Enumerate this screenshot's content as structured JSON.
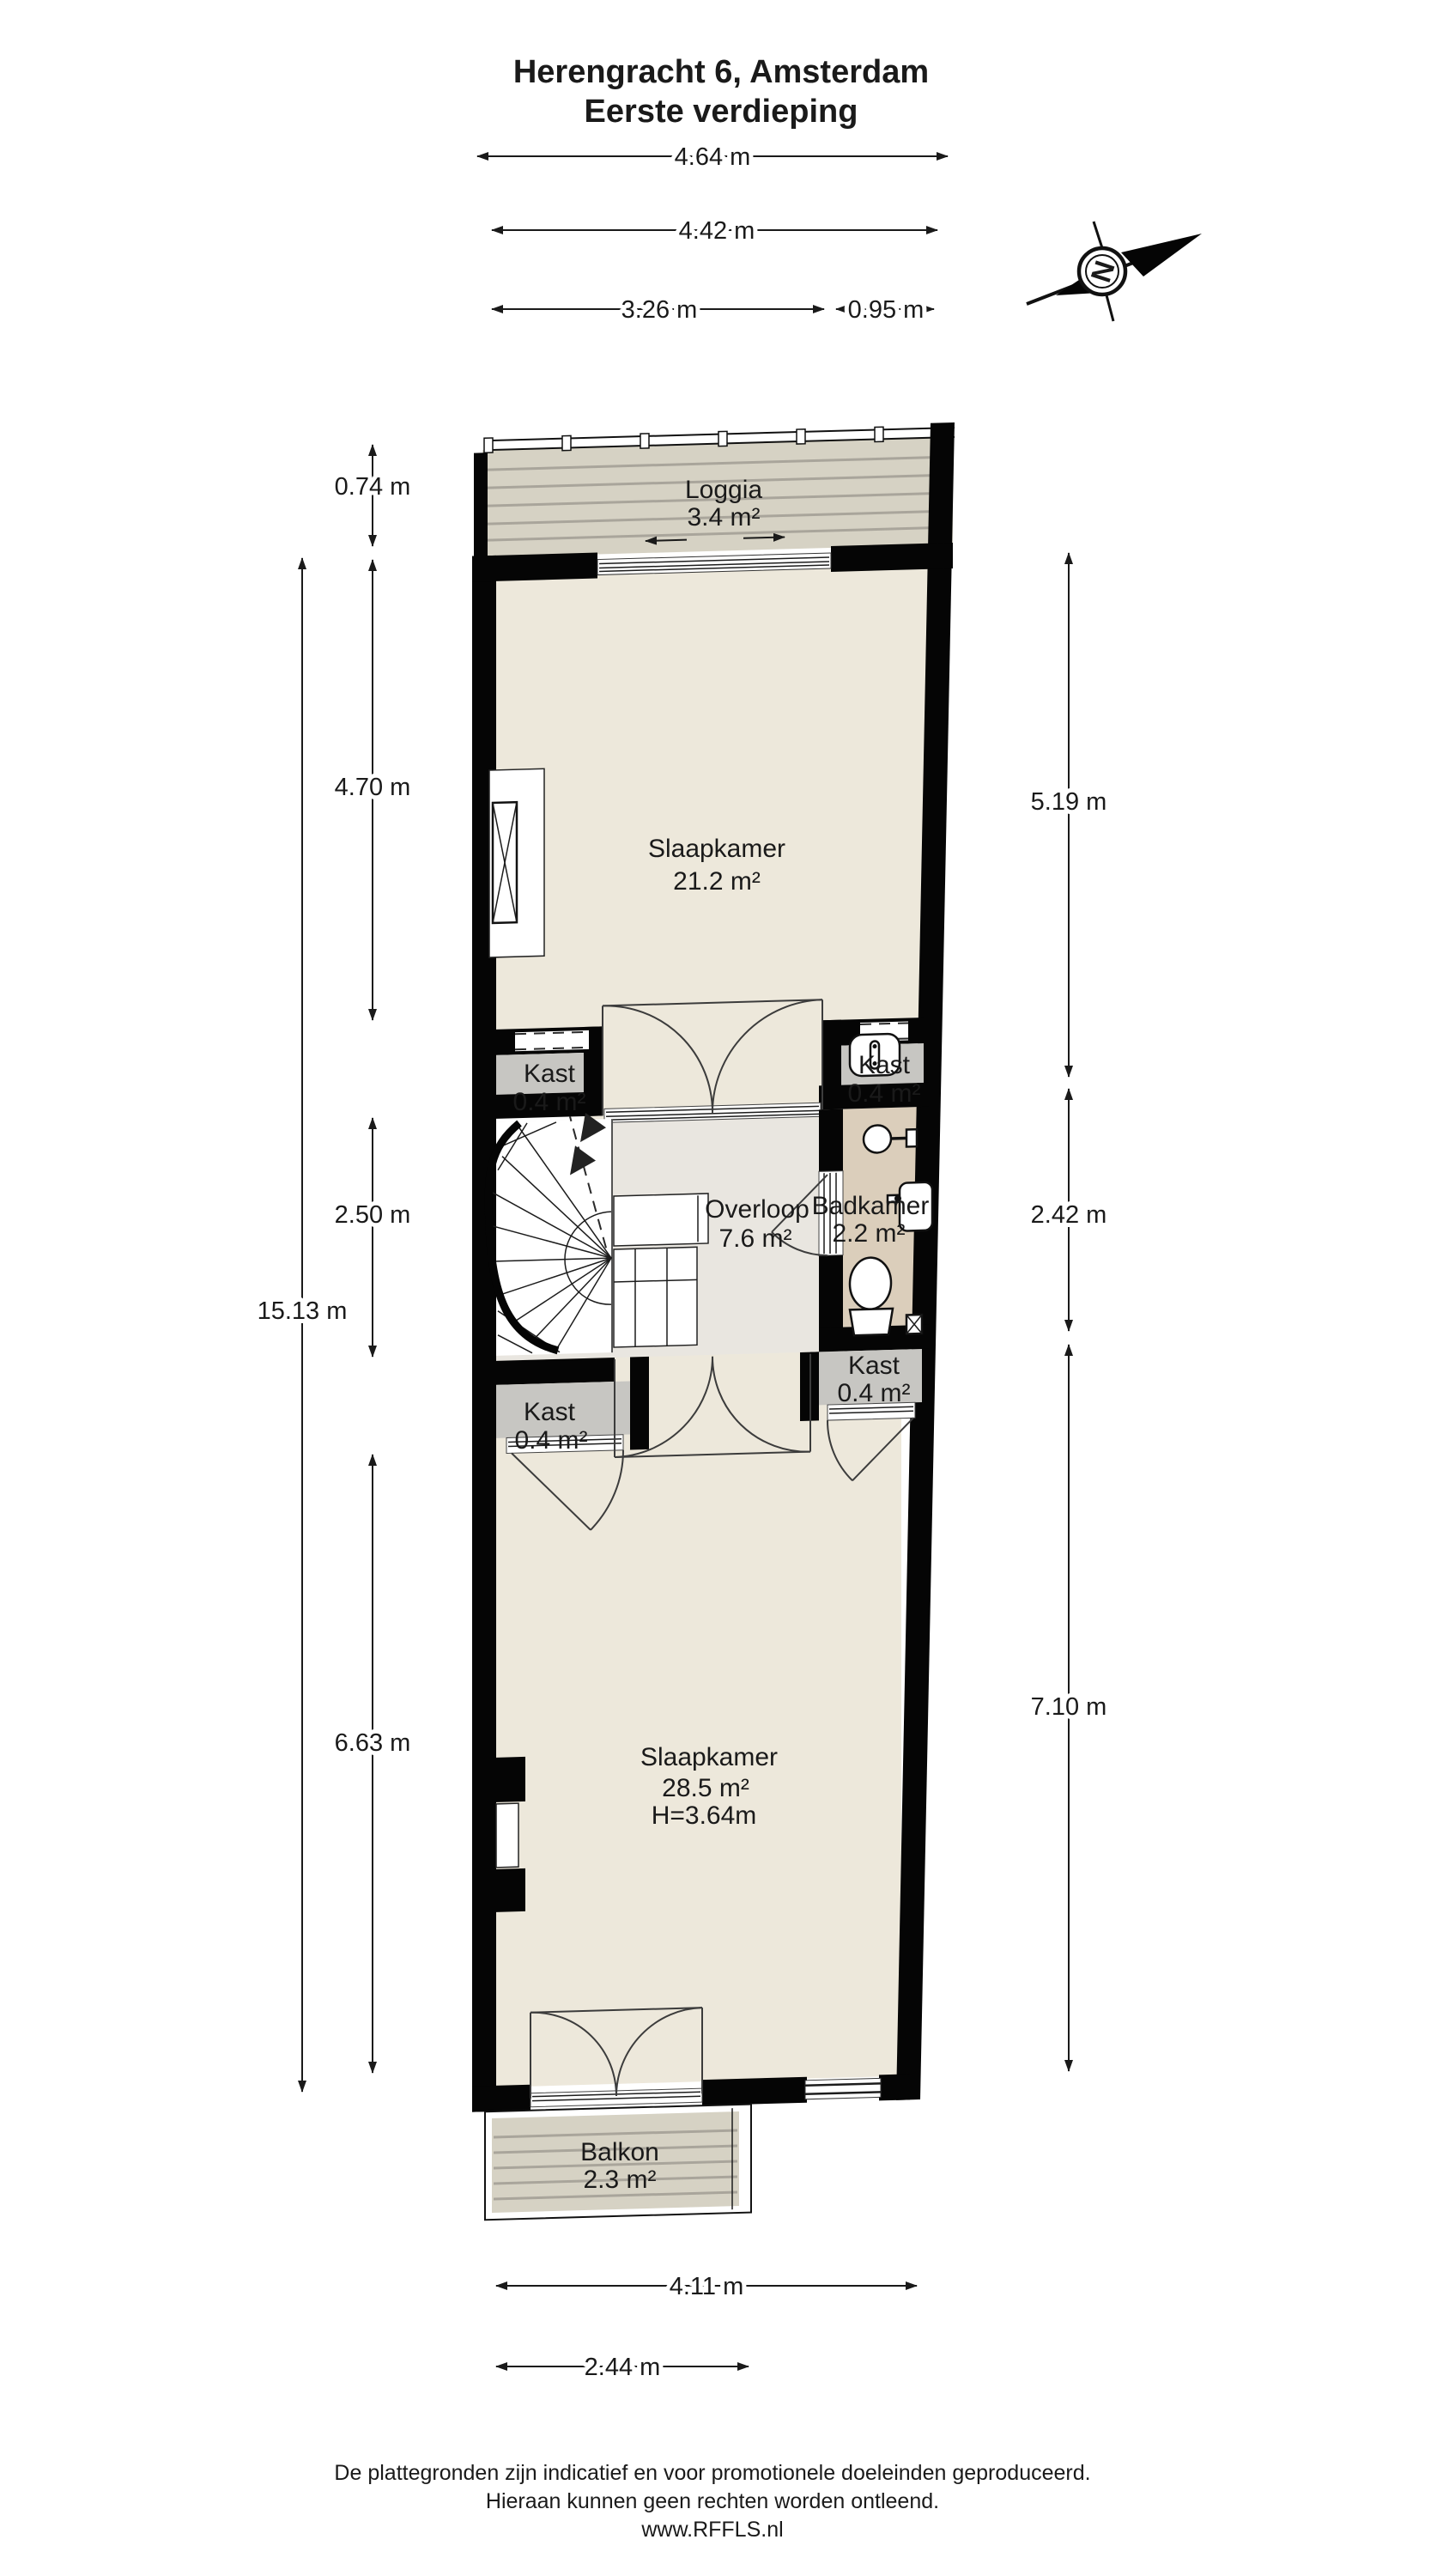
{
  "title": {
    "line1": "Herengracht 6, Amsterdam",
    "line2": "Eerste verdieping"
  },
  "compass": {
    "letter": "N"
  },
  "rooms": {
    "loggia": {
      "name": "Loggia",
      "area": "3.4 m²"
    },
    "slaapkamer1": {
      "name": "Slaapkamer",
      "area": "21.2 m²"
    },
    "kast_boven_links": {
      "name": "Kast",
      "area": "0.4 m²"
    },
    "kast_boven_rechts": {
      "name": "Kast",
      "area": "0.4 m²"
    },
    "overloop": {
      "name": "Overloop",
      "area": "7.6 m²"
    },
    "badkamer": {
      "name": "Badkamer",
      "area": "2.2 m²"
    },
    "kast_onder_links": {
      "name": "Kast",
      "area": "0.4 m²"
    },
    "kast_onder_rechts": {
      "name": "Kast",
      "area": "0.4 m²"
    },
    "slaapkamer2": {
      "name": "Slaapkamer",
      "area": "28.5 m²",
      "height": "H=3.64m"
    },
    "balkon": {
      "name": "Balkon",
      "area": "2.3 m²"
    }
  },
  "dimensions": {
    "top": [
      "4.64 m",
      "4.42 m",
      "3.26 m",
      "0.95 m"
    ],
    "left_outer": "15.13 m",
    "left_inner": [
      "0.74 m",
      "4.70 m",
      "2.50 m",
      "6.63 m"
    ],
    "right": [
      "5.19 m",
      "2.42 m",
      "7.10 m"
    ],
    "bottom": [
      "4.11 m",
      "2.44 m"
    ]
  },
  "footer": {
    "line1": "De plattegronden zijn indicatief en voor promotionele doeleinden geproduceerd.",
    "line2": "Hieraan kunnen geen rechten worden ontleend.",
    "line3": "www.RFFLS.nl"
  },
  "colors": {
    "wall": "#050505",
    "room_floor": "#EDE8DB",
    "hallway_floor": "#E9E6E0",
    "closet_floor": "#C7C6C2",
    "bathroom_floor": "#DBCEBB",
    "deck_floor": "#D6D2C4",
    "text": "#1a1a1a",
    "background": "#ffffff"
  }
}
